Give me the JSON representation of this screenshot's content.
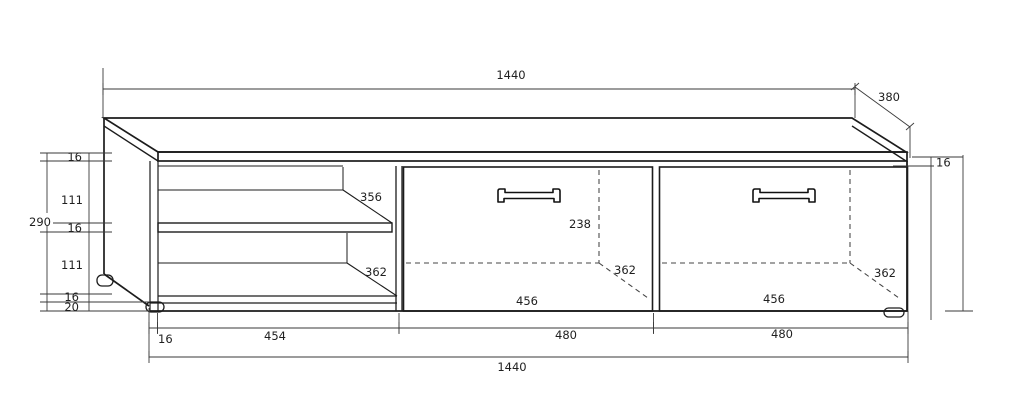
{
  "labels": {
    "top_width": "1440",
    "top_depth": "380",
    "right_top_thickness": "16",
    "left_height_total": "290",
    "left_segments": [
      "16",
      "111",
      "16",
      "111",
      "16",
      "20"
    ],
    "shelf_depth": "356",
    "open_bottom_depth": "362",
    "door1": {
      "inner_height": "238",
      "inner_depth": "362",
      "inner_width": "456"
    },
    "door2": {
      "inner_depth": "362",
      "inner_width": "456"
    },
    "bottom_segments": [
      "16",
      "454",
      "480",
      "480"
    ],
    "bottom_width_total": "1440"
  },
  "colors": {
    "background": "#ffffff",
    "line": "#1c1c1c",
    "dimension_line": "#3a3a3a",
    "text": "#1f1f1f"
  }
}
